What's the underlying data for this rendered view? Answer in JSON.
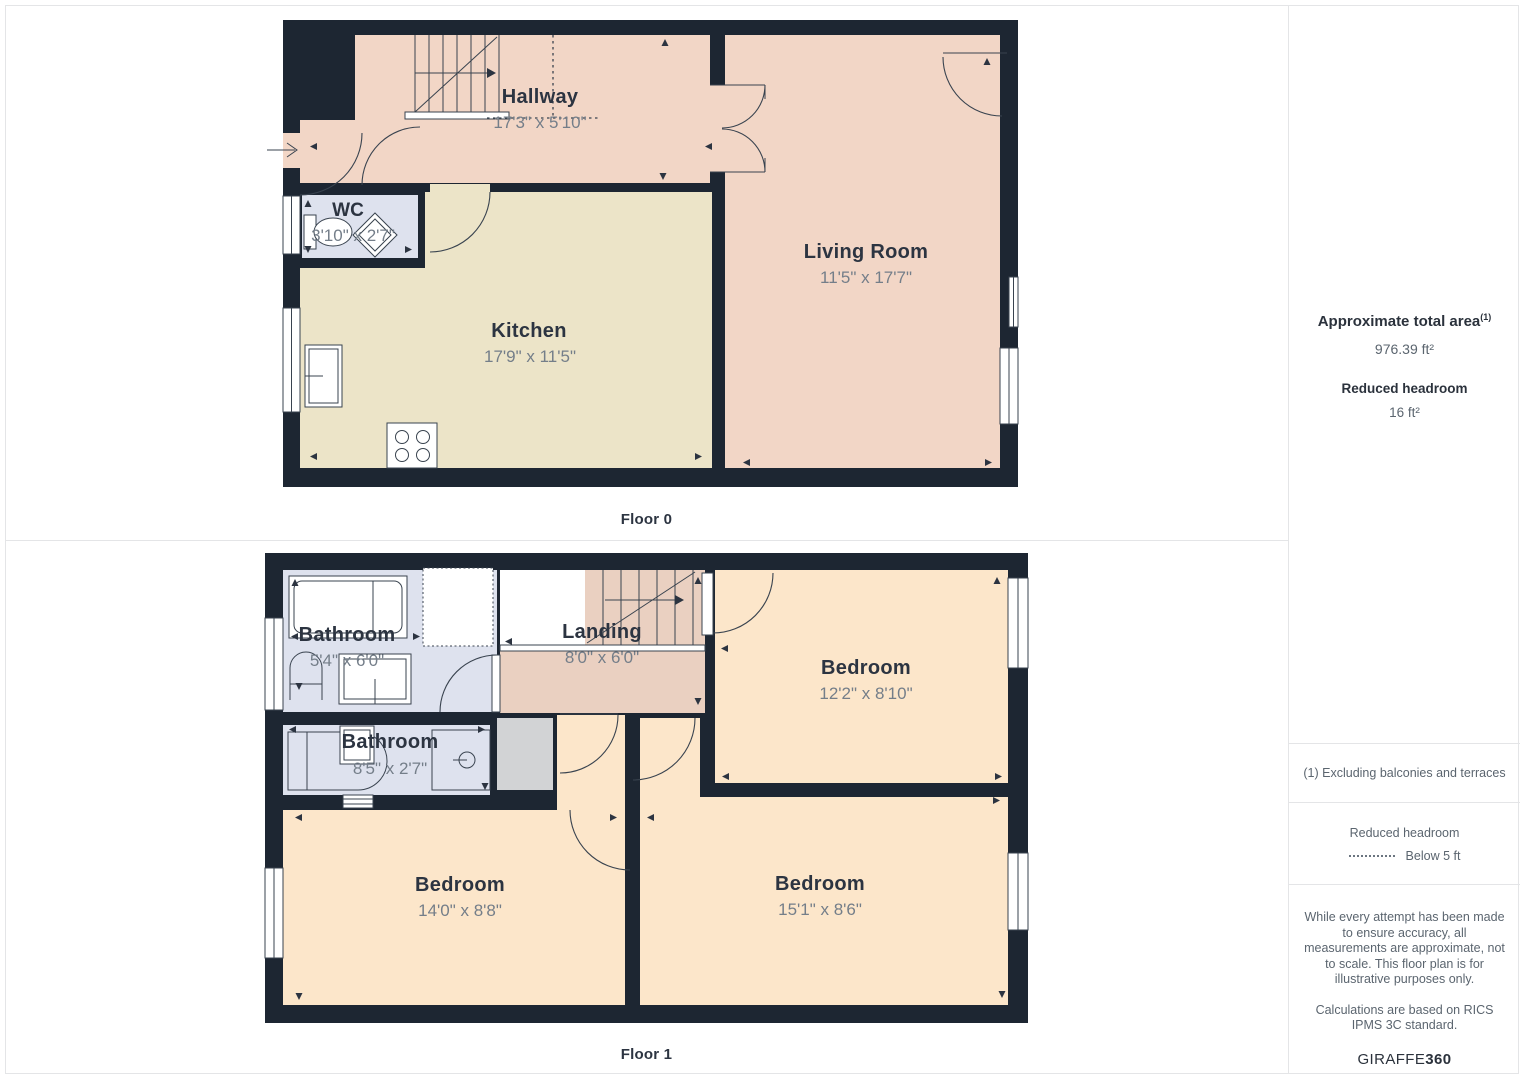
{
  "floors": [
    {
      "label": "Floor 0",
      "rooms": [
        {
          "name": "Hallway",
          "dims": "17'3\" x 5'10\""
        },
        {
          "name": "WC",
          "dims": "3'10\" x 2'7\""
        },
        {
          "name": "Kitchen",
          "dims": "17'9\" x 11'5\""
        },
        {
          "name": "Living Room",
          "dims": "11'5\" x 17'7\""
        }
      ]
    },
    {
      "label": "Floor 1",
      "rooms": [
        {
          "name": "Bathroom",
          "dims": "5'4\" x 6'0\""
        },
        {
          "name": "Landing",
          "dims": "8'0\" x 6'0\""
        },
        {
          "name": "Bedroom",
          "dims": "12'2\" x 8'10\""
        },
        {
          "name": "Bathroom",
          "dims": "8'5\" x 2'7\""
        },
        {
          "name": "Bedroom",
          "dims": "14'0\" x 8'8\""
        },
        {
          "name": "Bedroom",
          "dims": "15'1\" x 8'6\""
        }
      ]
    }
  ],
  "sidebar": {
    "total_area_label": "Approximate total area",
    "total_area_marker": "(1)",
    "total_area_value": "976.39 ft²",
    "reduced_headroom_label": "Reduced headroom",
    "reduced_headroom_value": "16 ft²",
    "footnote": "(1) Excluding balconies and terraces",
    "legend_title": "Reduced headroom",
    "legend_item": "Below 5 ft",
    "disclaimer1": "While every attempt has been made to ensure accuracy, all measurements are approximate, not to scale. This floor plan is for illustrative purposes only.",
    "disclaimer2": "Calculations are based on RICS IPMS 3C standard.",
    "brand_name": "GIRAFFE",
    "brand_suffix": "360"
  },
  "colors": {
    "wall": "#1d2632",
    "hallway": "#f2d6c6",
    "living_room": "#f2d6c6",
    "landing": "#ead0c1",
    "kitchen": "#ece4c8",
    "bathroom": "#dee2ee",
    "bedroom": "#fce6ca",
    "cupboard": "#d2d3d5"
  }
}
